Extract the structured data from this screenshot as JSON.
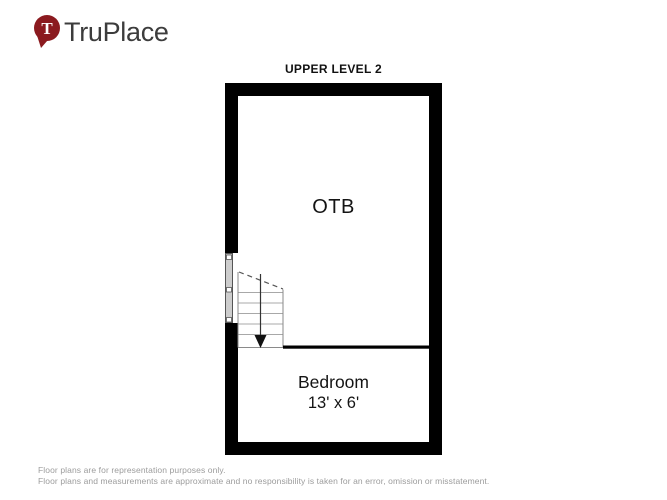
{
  "colors": {
    "brand": "#8B1A1F",
    "wall": "#000000",
    "logo_text": "#3C3C3C",
    "label": "#141414",
    "disclaimer": "#9C9C9C",
    "stair_line": "#8A8A8A",
    "tread_line": "#A8A8A8",
    "window_fill": "#CDCDCD"
  },
  "logo": {
    "text": "TruPlace",
    "pin_letter": "T"
  },
  "floorplan": {
    "title": "UPPER LEVEL 2",
    "rooms": [
      {
        "label": "OTB"
      },
      {
        "label": "Bedroom",
        "dimensions": "13' x 6'"
      }
    ],
    "features": [
      "stairs-down",
      "window-left-wall"
    ]
  },
  "footer": {
    "line1": "Floor plans are for representation purposes only.",
    "line2": "Floor plans and measurements are approximate and no responsibility is taken for an error, omission or misstatement."
  }
}
